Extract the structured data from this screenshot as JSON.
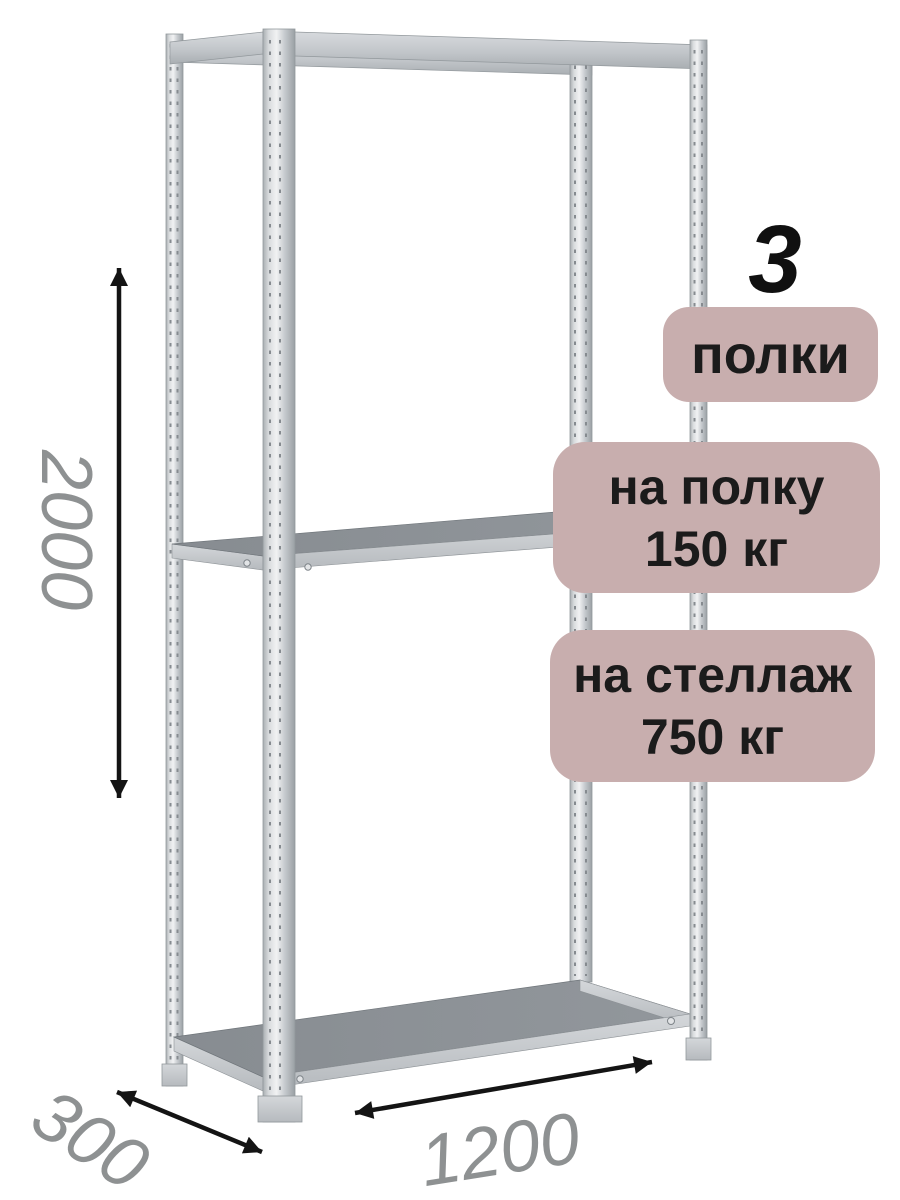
{
  "annotations": {
    "shelf_count": "3",
    "shelf_count_unit": "полки",
    "per_shelf": {
      "label": "на полку",
      "value": "150 кг"
    },
    "per_rack": {
      "label": "на стеллаж",
      "value": "750 кг"
    }
  },
  "dimensions": {
    "height": "2000",
    "depth": "300",
    "width": "1200"
  },
  "colors": {
    "badge_bg": "#c8aeae",
    "badge_text": "#1b1b1b",
    "dimension_label": "#8e9192",
    "arrow": "#141414",
    "metal_highlight": "#f1f2f3",
    "metal_mid": "#c6cace",
    "metal_edge": "#9aa0a4",
    "shelf_surface": "#8d9297",
    "background": "#ffffff"
  }
}
